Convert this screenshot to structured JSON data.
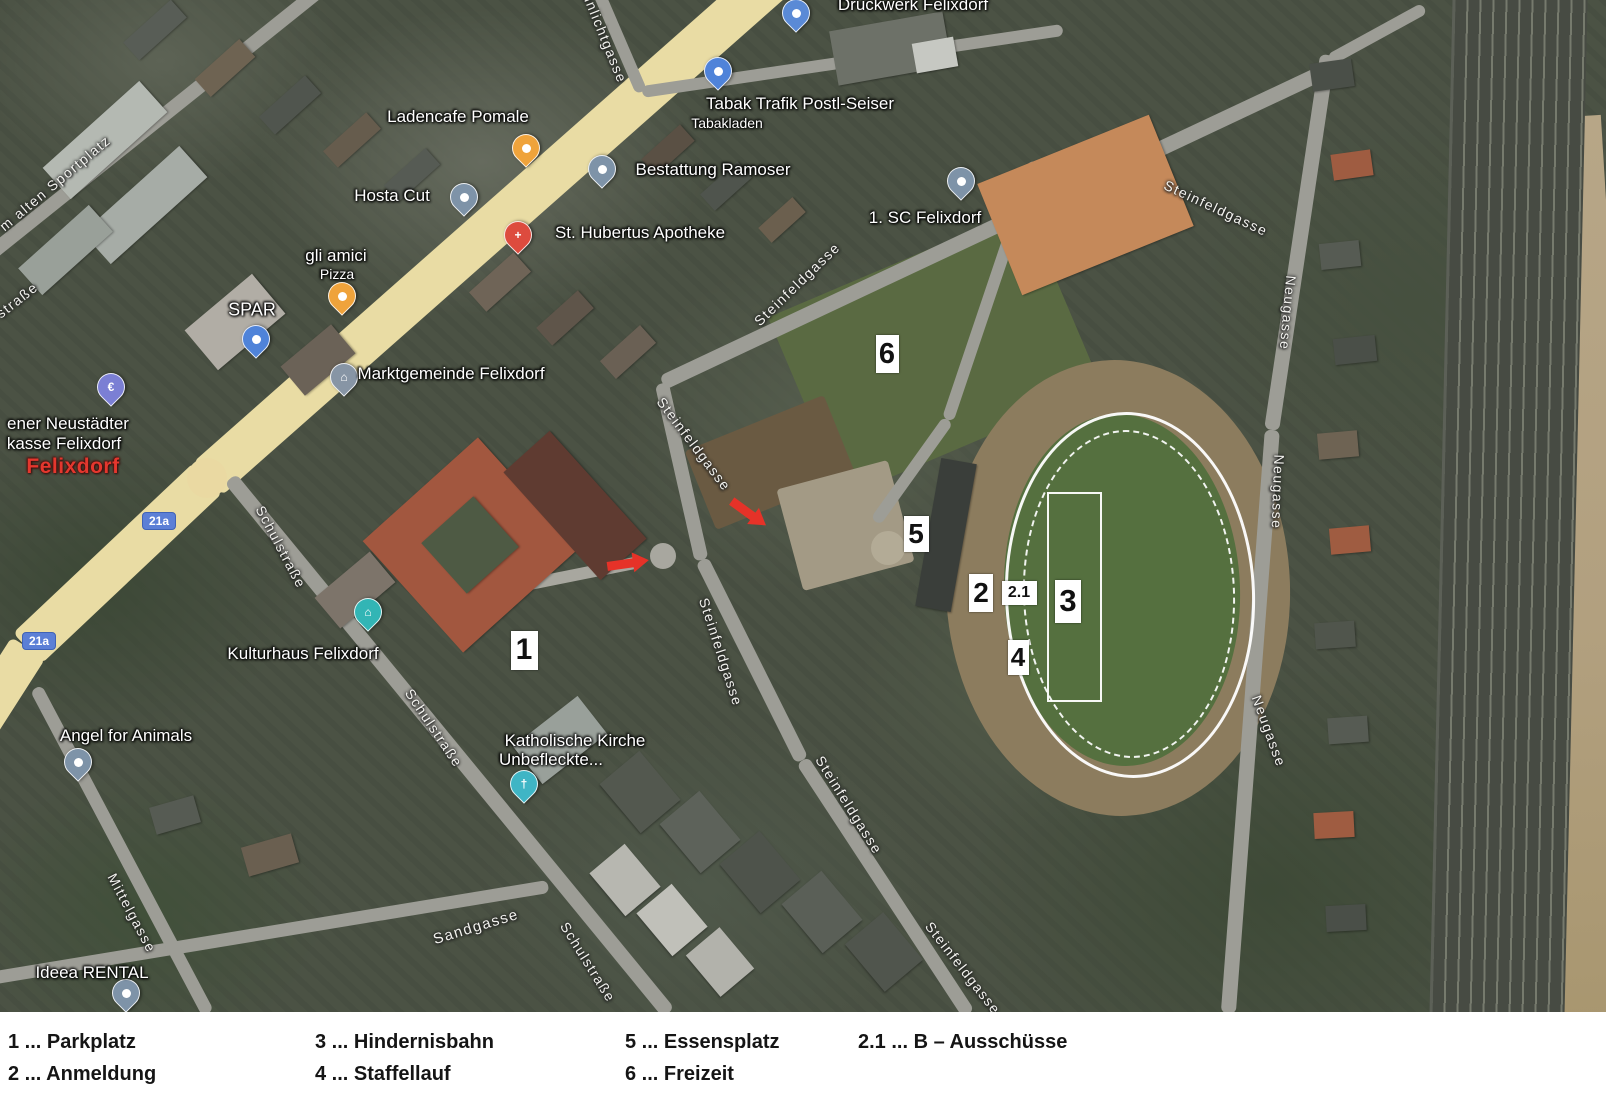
{
  "legend": {
    "columns": [
      {
        "x": 8,
        "items": [
          "1 ... Parkplatz",
          "2 ... Anmeldung"
        ]
      },
      {
        "x": 315,
        "items": [
          "3 ... Hindernisbahn",
          "4 ... Staffellauf"
        ]
      },
      {
        "x": 625,
        "items": [
          "5 ... Essensplatz",
          "6 ... Freizeit"
        ]
      },
      {
        "x": 858,
        "items": [
          "2.1 ... B – Ausschüsse"
        ]
      }
    ]
  },
  "map": {
    "town_label": "Felixdorf",
    "labels": [
      {
        "name": "ladencafe-pomale-label",
        "text": "Ladencafe Pomale",
        "x": 458,
        "y": 117,
        "size": 17,
        "angle": 0,
        "kind": "poi"
      },
      {
        "name": "hosta-cut-label",
        "text": "Hosta Cut",
        "x": 392,
        "y": 196,
        "size": 17,
        "angle": 0,
        "kind": "poi"
      },
      {
        "name": "bestattung-ramoser-label",
        "text": "Bestattung Ramoser",
        "x": 713,
        "y": 170,
        "size": 17,
        "angle": 0,
        "kind": "poi"
      },
      {
        "name": "st-hubertus-apotheke-label",
        "text": "St. Hubertus Apotheke",
        "x": 640,
        "y": 233,
        "size": 17,
        "angle": 0,
        "kind": "poi"
      },
      {
        "name": "gli-amici-label",
        "text": "gli amici",
        "x": 336,
        "y": 256,
        "size": 17,
        "angle": 0,
        "kind": "poi"
      },
      {
        "name": "gli-amici-sublabel",
        "text": "Pizza",
        "x": 337,
        "y": 274,
        "size": 14,
        "angle": 0,
        "kind": "poi"
      },
      {
        "name": "spar-label",
        "text": "SPAR",
        "x": 252,
        "y": 310,
        "size": 18,
        "angle": 0,
        "kind": "poi"
      },
      {
        "name": "marktgemeinde-label",
        "text": "Marktgemeinde Felixdorf",
        "x": 451,
        "y": 374,
        "size": 17,
        "angle": 0,
        "kind": "poi"
      },
      {
        "name": "tabak-trafik-label",
        "text": "Tabak Trafik Postl-Seiser",
        "x": 800,
        "y": 104,
        "size": 17,
        "angle": 0,
        "kind": "poi"
      },
      {
        "name": "tabak-trafik-sublabel",
        "text": "Tabakladen",
        "x": 727,
        "y": 123,
        "size": 14,
        "angle": 0,
        "kind": "poi"
      },
      {
        "name": "druckwerk-felixdorf-label",
        "text": "Druckwerk Felixdorf",
        "x": 913,
        "y": 5,
        "size": 17,
        "angle": 0,
        "kind": "poi"
      },
      {
        "name": "sc-felixdorf-label",
        "text": "1. SC Felixdorf",
        "x": 925,
        "y": 218,
        "size": 17,
        "angle": 0,
        "kind": "poi"
      },
      {
        "name": "sparkasse-label-line1",
        "text": "ener Neustädter",
        "x": 68,
        "y": 424,
        "size": 17,
        "angle": 0,
        "kind": "poi"
      },
      {
        "name": "sparkasse-label-line2",
        "text": "kasse Felixdorf",
        "x": 64,
        "y": 444,
        "size": 17,
        "angle": 0,
        "kind": "poi"
      },
      {
        "name": "town-label-felixdorf",
        "text": "Felixdorf",
        "x": 73,
        "y": 467,
        "size": 21,
        "angle": 0,
        "kind": "town"
      },
      {
        "name": "kulturhaus-label",
        "text": "Kulturhaus Felixdorf",
        "x": 303,
        "y": 654,
        "size": 17,
        "angle": 0,
        "kind": "poi"
      },
      {
        "name": "kirche-label-line1",
        "text": "Katholische Kirche",
        "x": 575,
        "y": 741,
        "size": 17,
        "angle": 0,
        "kind": "poi"
      },
      {
        "name": "kirche-label-line2",
        "text": "Unbefleckte...",
        "x": 551,
        "y": 760,
        "size": 17,
        "angle": 0,
        "kind": "poi"
      },
      {
        "name": "angel-for-animals-label",
        "text": "Angel for Animals",
        "x": 126,
        "y": 736,
        "size": 17,
        "angle": 0,
        "kind": "poi"
      },
      {
        "name": "ideea-rental-label",
        "text": "Ideea RENTAL",
        "x": 92,
        "y": 973,
        "size": 17,
        "angle": 0,
        "kind": "poi"
      },
      {
        "name": "street-sunlichtgasse",
        "text": "unlichtgasse",
        "x": 605,
        "y": 38,
        "size": 14,
        "angle": 68,
        "kind": "street"
      },
      {
        "name": "street-am-alten-sportplatz",
        "text": "m alten Sportplatz",
        "x": 55,
        "y": 183,
        "size": 14,
        "angle": -40,
        "kind": "street"
      },
      {
        "name": "street-strasse-partial",
        "text": "straße",
        "x": 17,
        "y": 300,
        "size": 14,
        "angle": -38,
        "kind": "street"
      },
      {
        "name": "street-schulstrasse-1",
        "text": "Schulstraße",
        "x": 281,
        "y": 547,
        "size": 14,
        "angle": 62,
        "kind": "street"
      },
      {
        "name": "street-schulstrasse-2",
        "text": "Schulstraße",
        "x": 434,
        "y": 728,
        "size": 14,
        "angle": 56,
        "kind": "street"
      },
      {
        "name": "street-schulstrasse-3",
        "text": "Schulstraße",
        "x": 588,
        "y": 962,
        "size": 14,
        "angle": 58,
        "kind": "street"
      },
      {
        "name": "street-steinfeldgasse-1",
        "text": "Steinfeldgasse",
        "x": 1216,
        "y": 208,
        "size": 14,
        "angle": 25,
        "kind": "street"
      },
      {
        "name": "street-steinfeldgasse-2",
        "text": "Steinfeldgasse",
        "x": 797,
        "y": 284,
        "size": 14,
        "angle": -44,
        "kind": "street"
      },
      {
        "name": "street-steinfeldgasse-3",
        "text": "Steinfeldgasse",
        "x": 694,
        "y": 444,
        "size": 14,
        "angle": 53,
        "kind": "street"
      },
      {
        "name": "street-steinfeldgasse-4",
        "text": "Steinfeldgasse",
        "x": 721,
        "y": 652,
        "size": 14,
        "angle": 72,
        "kind": "street"
      },
      {
        "name": "street-steinfeldgasse-5",
        "text": "Steinfeldgasse",
        "x": 849,
        "y": 805,
        "size": 14,
        "angle": 58,
        "kind": "street"
      },
      {
        "name": "street-steinfeldgasse-6",
        "text": "Steinfeldgasse",
        "x": 963,
        "y": 968,
        "size": 14,
        "angle": 52,
        "kind": "street"
      },
      {
        "name": "street-sandgasse",
        "text": "Sandgasse",
        "x": 476,
        "y": 927,
        "size": 15,
        "angle": -17,
        "kind": "street"
      },
      {
        "name": "street-mittelgasse",
        "text": "Mittelgasse",
        "x": 132,
        "y": 913,
        "size": 14,
        "angle": 62,
        "kind": "street"
      },
      {
        "name": "street-neugasse-1",
        "text": "Neugasse",
        "x": 1288,
        "y": 313,
        "size": 14,
        "angle": 95,
        "kind": "street"
      },
      {
        "name": "street-neugasse-2",
        "text": "Neugasse",
        "x": 1278,
        "y": 492,
        "size": 14,
        "angle": 92,
        "kind": "street"
      },
      {
        "name": "street-neugasse-3",
        "text": "Neugasse",
        "x": 1269,
        "y": 731,
        "size": 14,
        "angle": 70,
        "kind": "street"
      }
    ],
    "pins": [
      {
        "name": "druckwerk-felixdorf-pin",
        "x": 795,
        "y": 30,
        "color": "#5a8ad6",
        "glyph": "dot"
      },
      {
        "name": "tabak-trafik-pin",
        "x": 717,
        "y": 88,
        "color": "#4f83d9",
        "glyph": "dot"
      },
      {
        "name": "ladencafe-pomale-pin",
        "x": 525,
        "y": 165,
        "color": "#efa33b",
        "glyph": "dot"
      },
      {
        "name": "hosta-cut-pin",
        "x": 463,
        "y": 214,
        "color": "#7e93a8",
        "glyph": "dot"
      },
      {
        "name": "bestattung-ramoser-pin",
        "x": 601,
        "y": 186,
        "color": "#7e93a8",
        "glyph": "dot"
      },
      {
        "name": "st-hubertus-apotheke-pin",
        "x": 517,
        "y": 252,
        "color": "#dd4b3e",
        "glyph": "cross"
      },
      {
        "name": "gli-amici-pin",
        "x": 341,
        "y": 313,
        "color": "#efa33b",
        "glyph": "dot"
      },
      {
        "name": "spar-pin",
        "x": 255,
        "y": 356,
        "color": "#4f83d9",
        "glyph": "dot"
      },
      {
        "name": "marktgemeinde-pin",
        "x": 343,
        "y": 394,
        "color": "#8795a5",
        "glyph": "bank"
      },
      {
        "name": "sc-felixdorf-pin",
        "x": 960,
        "y": 198,
        "color": "#7e93a8",
        "glyph": "dot"
      },
      {
        "name": "sparkasse-euro-pin",
        "x": 110,
        "y": 404,
        "color": "#7b7fd4",
        "glyph": "euro"
      },
      {
        "name": "kulturhaus-pin",
        "x": 367,
        "y": 629,
        "color": "#32b5b5",
        "glyph": "bank"
      },
      {
        "name": "kirche-pin",
        "x": 523,
        "y": 801,
        "color": "#3fb5c5",
        "glyph": "church"
      },
      {
        "name": "angel-for-animals-pin",
        "x": 77,
        "y": 779,
        "color": "#7e93a8",
        "glyph": "dot"
      },
      {
        "name": "ideea-rental-pin",
        "x": 125,
        "y": 1010,
        "color": "#7e93a8",
        "glyph": "dot"
      }
    ],
    "markers": [
      {
        "label": "1",
        "x": 524,
        "y": 650,
        "w": 27,
        "h": 39,
        "fs": 30
      },
      {
        "label": "5",
        "x": 916,
        "y": 534,
        "w": 25,
        "h": 36,
        "fs": 28
      },
      {
        "label": "2",
        "x": 981,
        "y": 593,
        "w": 24,
        "h": 38,
        "fs": 28
      },
      {
        "label": "2.1",
        "x": 1019,
        "y": 593,
        "w": 35,
        "h": 24,
        "fs": 16
      },
      {
        "label": "3",
        "x": 1068,
        "y": 601,
        "w": 26,
        "h": 43,
        "fs": 31
      },
      {
        "label": "4",
        "x": 1018,
        "y": 657,
        "w": 21,
        "h": 35,
        "fs": 26
      },
      {
        "label": "6",
        "x": 887,
        "y": 354,
        "w": 23,
        "h": 38,
        "fs": 29
      }
    ],
    "arrows": [
      {
        "name": "red-arrow-west",
        "x": 628,
        "y": 563,
        "angle": -8
      },
      {
        "name": "red-arrow-north",
        "x": 749,
        "y": 513,
        "angle": 36
      }
    ],
    "road_badges": [
      {
        "label": "21a",
        "x": 142,
        "y": 512
      },
      {
        "label": "21a",
        "x": 22,
        "y": 632
      }
    ],
    "colors": {
      "arrow": "#e63228",
      "track_line": "#ffffff",
      "badge": "#5b7fd6",
      "town_label": "#e4372e",
      "main_road": "#e9dca4",
      "pitch_green": "#55703f"
    }
  }
}
